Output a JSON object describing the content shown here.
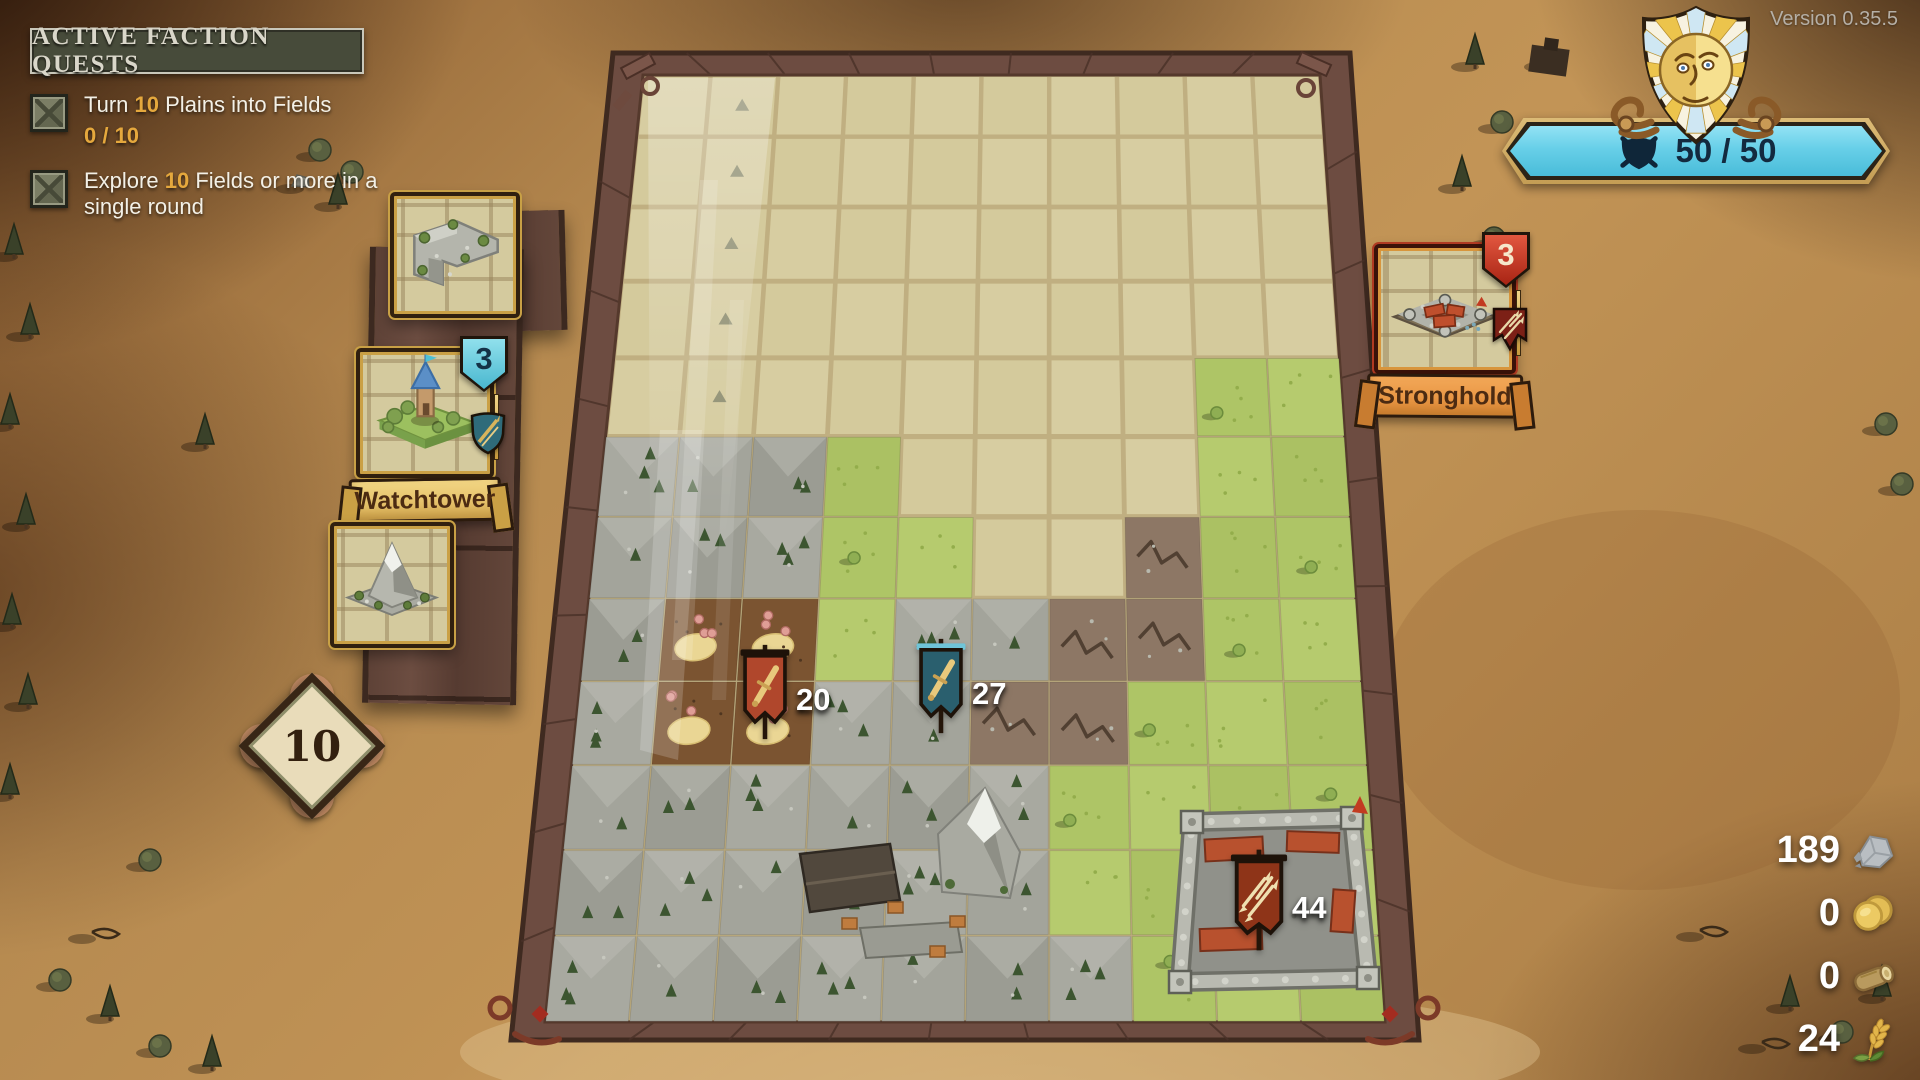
{
  "version_label": "Version 0.35.5",
  "quest_panel": {
    "title": "ACTIVE FACTION QUESTS",
    "quests": [
      {
        "prefix": "Turn ",
        "amount": "10",
        "suffix": " Plains into Fields",
        "progress": "0 / 10"
      },
      {
        "prefix": "Explore ",
        "amount": "10",
        "suffix": " Fields or more in a single round",
        "progress": ""
      }
    ]
  },
  "morale": {
    "value": "50 / 50",
    "icon": "shield-crossed-swords-icon",
    "bar_color": "#67cfe8"
  },
  "hand": {
    "deck_count": "10",
    "cards": {
      "tile_top": {
        "type": "rock-corner-tile"
      },
      "watchtower": {
        "name": "Watchtower",
        "count": "3"
      },
      "tile_bottom": {
        "type": "mountain-tile"
      }
    }
  },
  "stronghold_card": {
    "name": "Stronghold",
    "count": "3"
  },
  "armies": [
    {
      "id": "red",
      "value": "20",
      "banner_color": "#b0472c",
      "emblem": "sword"
    },
    {
      "id": "teal",
      "value": "27",
      "banner_color": "#2a5f6e",
      "emblem": "sword"
    },
    {
      "id": "rust",
      "value": "44",
      "banner_color": "#8e3418",
      "emblem": "arrows"
    }
  ],
  "resources": [
    {
      "name": "stone",
      "value": "189"
    },
    {
      "name": "coins",
      "value": "0"
    },
    {
      "name": "wood",
      "value": "0"
    },
    {
      "name": "wheat",
      "value": "24"
    }
  ],
  "board": {
    "cols": 10,
    "rows": 12,
    "tiles": [
      "EEEEEEEEEE",
      "EEEEEEEEEE",
      "EEEEEEEEEE",
      "EEEEEEEEEE",
      "EEEEEEEEGG",
      "RRRGEEEEGG",
      "RRRGGEECGG",
      "RDDGRRCCGG",
      "RDDRRCCGGG",
      "RRRRRMGGGG",
      "RRRVRRGGGG",
      "RRRRRRRGGG"
    ],
    "markers": [
      [
        1,
        0
      ],
      [
        1,
        1
      ],
      [
        1,
        2
      ],
      [
        1,
        3
      ],
      [
        1,
        4
      ]
    ],
    "colors": {
      "empty": "#d7cda1",
      "grass": "#b2c868",
      "rock": "#a1a29a",
      "farm": "#7b5431",
      "crack": "#8d7765",
      "gutter": "#c0af81",
      "rim": "#6d4c41"
    }
  }
}
